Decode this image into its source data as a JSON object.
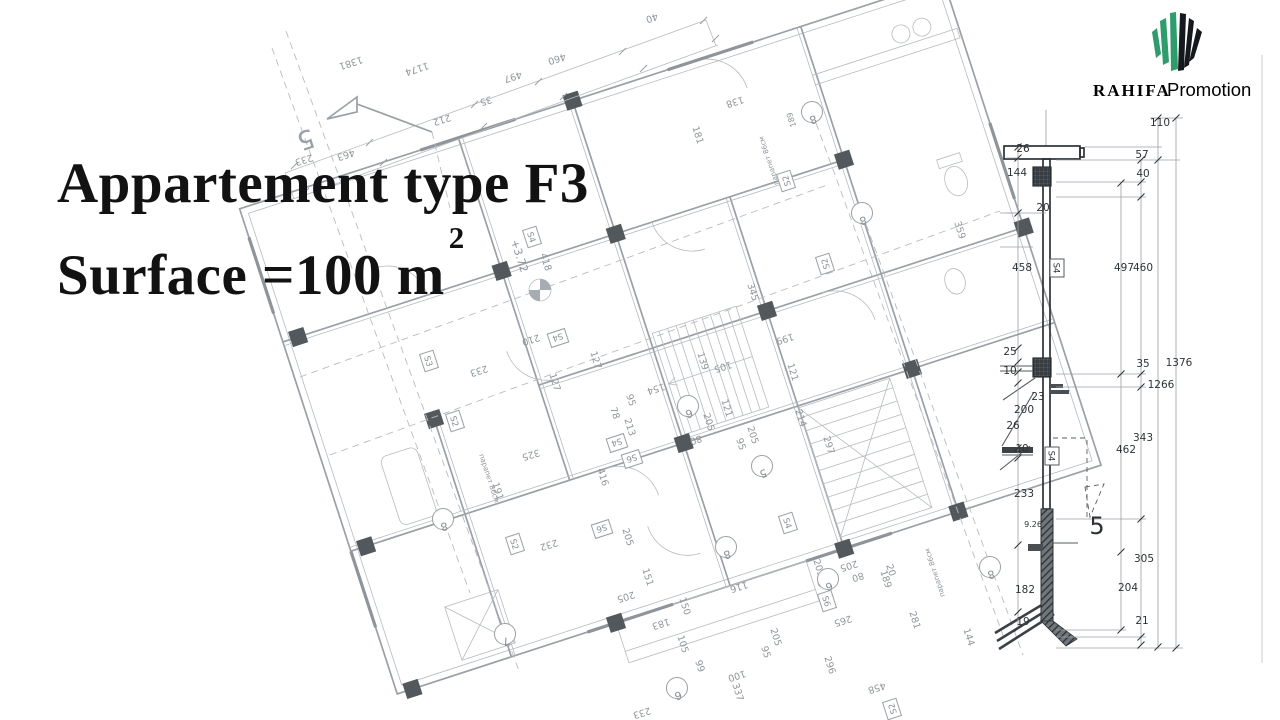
{
  "title": {
    "line1": "Appartement type F3",
    "line2": "Surface =100 m",
    "sup": "2"
  },
  "logo": {
    "brand": "RAHIFA",
    "suffix": "Promotion",
    "green": "#2f9c6e",
    "dark": "#15181c",
    "brand_color": "#1d2630",
    "suffix_color": "#4fa294"
  },
  "plan": {
    "cut_label": "5",
    "labels": [
      {
        "x": 350,
        "y": 60,
        "t": "1381",
        "r": 162
      },
      {
        "x": 416,
        "y": 66,
        "t": "1174",
        "r": 162
      },
      {
        "x": 556,
        "y": 56,
        "t": "460",
        "r": 162
      },
      {
        "x": 512,
        "y": 74,
        "t": "497",
        "r": 162
      },
      {
        "x": 485,
        "y": 98,
        "t": "35",
        "r": 162
      },
      {
        "x": 441,
        "y": 117,
        "t": "212",
        "r": 162
      },
      {
        "x": 651,
        "y": 15,
        "t": "40",
        "r": 162
      },
      {
        "x": 734,
        "y": 99,
        "t": "138",
        "r": 162
      },
      {
        "x": 695,
        "y": 136,
        "t": "181",
        "r": 72
      },
      {
        "x": 303,
        "y": 157,
        "t": "233",
        "r": 162
      },
      {
        "x": 345,
        "y": 152,
        "t": "463",
        "r": 162
      },
      {
        "x": 303,
        "y": 131,
        "t": "5",
        "r": 162,
        "f": 26,
        "c": "#9aa0a6"
      },
      {
        "x": 478,
        "y": 368,
        "t": "233",
        "r": 162
      },
      {
        "x": 530,
        "y": 337,
        "t": "210",
        "r": 162
      },
      {
        "x": 552,
        "y": 383,
        "t": "127",
        "r": 72
      },
      {
        "x": 593,
        "y": 361,
        "t": "127",
        "r": 72
      },
      {
        "x": 627,
        "y": 428,
        "t": "213",
        "r": 72
      },
      {
        "x": 612,
        "y": 414,
        "t": "78",
        "r": 72
      },
      {
        "x": 628,
        "y": 401,
        "t": "95",
        "r": 72
      },
      {
        "x": 655,
        "y": 386,
        "t": "154",
        "r": 162
      },
      {
        "x": 700,
        "y": 362,
        "t": "139",
        "r": 72
      },
      {
        "x": 722,
        "y": 364,
        "t": "105",
        "r": 162
      },
      {
        "x": 695,
        "y": 437,
        "t": "80",
        "r": 162
      },
      {
        "x": 706,
        "y": 423,
        "t": "205",
        "r": 72
      },
      {
        "x": 724,
        "y": 409,
        "t": "121",
        "r": 72
      },
      {
        "x": 738,
        "y": 445,
        "t": "95",
        "r": 72
      },
      {
        "x": 750,
        "y": 436,
        "t": "205",
        "r": 72
      },
      {
        "x": 790,
        "y": 373,
        "t": "121",
        "r": 72
      },
      {
        "x": 784,
        "y": 336,
        "t": "199",
        "r": 162
      },
      {
        "x": 798,
        "y": 419,
        "t": "214",
        "r": 72
      },
      {
        "x": 826,
        "y": 446,
        "t": "297",
        "r": 72
      },
      {
        "x": 530,
        "y": 452,
        "t": "325",
        "r": 162
      },
      {
        "x": 600,
        "y": 478,
        "t": "416",
        "r": 72
      },
      {
        "x": 495,
        "y": 492,
        "t": "191",
        "r": 72
      },
      {
        "x": 543,
        "y": 263,
        "t": "418",
        "r": 72
      },
      {
        "x": 516,
        "y": 257,
        "t": "+3.72",
        "r": 72,
        "f": 11
      },
      {
        "x": 548,
        "y": 542,
        "t": "232",
        "r": 162
      },
      {
        "x": 625,
        "y": 538,
        "t": "205",
        "r": 72
      },
      {
        "x": 645,
        "y": 578,
        "t": "151",
        "r": 72
      },
      {
        "x": 625,
        "y": 594,
        "t": "205",
        "r": 162
      },
      {
        "x": 660,
        "y": 621,
        "t": "183",
        "r": 162
      },
      {
        "x": 682,
        "y": 607,
        "t": "150",
        "r": 72
      },
      {
        "x": 738,
        "y": 584,
        "t": "116",
        "r": 162
      },
      {
        "x": 680,
        "y": 645,
        "t": "105",
        "r": 72
      },
      {
        "x": 697,
        "y": 667,
        "t": "99",
        "r": 72
      },
      {
        "x": 736,
        "y": 673,
        "t": "100",
        "r": 162
      },
      {
        "x": 735,
        "y": 693,
        "t": "337",
        "r": 72
      },
      {
        "x": 641,
        "y": 710,
        "t": "233",
        "r": 162
      },
      {
        "x": 827,
        "y": 666,
        "t": "296",
        "r": 72
      },
      {
        "x": 842,
        "y": 618,
        "t": "265",
        "r": 162
      },
      {
        "x": 773,
        "y": 638,
        "t": "205",
        "r": 72
      },
      {
        "x": 763,
        "y": 653,
        "t": "95",
        "r": 72
      },
      {
        "x": 822,
        "y": 579,
        "t": "80",
        "r": 162
      },
      {
        "x": 816,
        "y": 569,
        "t": "205",
        "r": 72
      },
      {
        "x": 848,
        "y": 563,
        "t": "205",
        "r": 162
      },
      {
        "x": 857,
        "y": 574,
        "t": "80",
        "r": 162
      },
      {
        "x": 912,
        "y": 621,
        "t": "281",
        "r": 72
      },
      {
        "x": 888,
        "y": 571,
        "t": "20",
        "r": 72
      },
      {
        "x": 966,
        "y": 638,
        "t": "144",
        "r": 72
      },
      {
        "x": 876,
        "y": 685,
        "t": "458",
        "r": 162
      },
      {
        "x": 883,
        "y": 580,
        "t": "189",
        "r": 72
      },
      {
        "x": 794,
        "y": 119,
        "t": "189",
        "r": 252,
        "f": 8
      },
      {
        "x": 750,
        "y": 293,
        "t": "345",
        "r": 72
      },
      {
        "x": 957,
        "y": 231,
        "t": "359",
        "r": 72
      },
      {
        "x": 487,
        "y": 479,
        "t": "парапет 86см",
        "r": 72,
        "f": 7
      },
      {
        "x": 937,
        "y": 572,
        "t": "парапет 86см",
        "r": 252,
        "f": 7
      },
      {
        "x": 771,
        "y": 160,
        "t": "парапет 86см",
        "r": 252,
        "f": 7
      }
    ],
    "bubbles": [
      {
        "x": 812,
        "y": 112,
        "t": "8"
      },
      {
        "x": 862,
        "y": 213,
        "t": "8"
      },
      {
        "x": 443,
        "y": 519,
        "t": "8"
      },
      {
        "x": 505,
        "y": 634,
        "t": "7"
      },
      {
        "x": 726,
        "y": 547,
        "t": "8"
      },
      {
        "x": 762,
        "y": 466,
        "t": "5"
      },
      {
        "x": 688,
        "y": 406,
        "t": "6"
      },
      {
        "x": 677,
        "y": 688,
        "t": "6"
      },
      {
        "x": 828,
        "y": 579,
        "t": "6"
      },
      {
        "x": 990,
        "y": 567,
        "t": "8"
      }
    ],
    "tags": [
      {
        "x": 558,
        "y": 338,
        "t": "S4",
        "r": 162
      },
      {
        "x": 515,
        "y": 544,
        "t": "S2",
        "r": 72
      },
      {
        "x": 786,
        "y": 181,
        "t": "S2",
        "r": 252
      },
      {
        "x": 825,
        "y": 264,
        "t": "S2",
        "r": 252
      },
      {
        "x": 602,
        "y": 529,
        "t": "S6",
        "r": 162
      },
      {
        "x": 788,
        "y": 523,
        "t": "S4",
        "r": 72
      },
      {
        "x": 429,
        "y": 361,
        "t": "S3",
        "r": 72
      },
      {
        "x": 455,
        "y": 421,
        "t": "S2",
        "r": 72
      },
      {
        "x": 632,
        "y": 459,
        "t": "S6",
        "r": 162
      },
      {
        "x": 617,
        "y": 443,
        "t": "S4",
        "r": 162
      },
      {
        "x": 532,
        "y": 237,
        "t": "S4",
        "r": 72
      },
      {
        "x": 827,
        "y": 601,
        "t": "S6",
        "r": 72
      },
      {
        "x": 892,
        "y": 709,
        "t": "S2",
        "r": 252
      }
    ]
  },
  "section": {
    "labels": [
      {
        "x": 1023,
        "y": 152,
        "t": "26"
      },
      {
        "x": 1017,
        "y": 176,
        "t": "144"
      },
      {
        "x": 1043,
        "y": 211,
        "t": "20"
      },
      {
        "x": 1022,
        "y": 271,
        "t": "458"
      },
      {
        "x": 1010,
        "y": 355,
        "t": "25"
      },
      {
        "x": 1010,
        "y": 374,
        "t": "10"
      },
      {
        "x": 1038,
        "y": 400,
        "t": "23"
      },
      {
        "x": 1024,
        "y": 413,
        "t": "200"
      },
      {
        "x": 1013,
        "y": 429,
        "t": "26"
      },
      {
        "x": 1022,
        "y": 452,
        "t": "10"
      },
      {
        "x": 1024,
        "y": 497,
        "t": "233"
      },
      {
        "x": 1033,
        "y": 527,
        "t": "9.26",
        "f": 8
      },
      {
        "x": 1025,
        "y": 593,
        "t": "182"
      },
      {
        "x": 1023,
        "y": 625,
        "t": "19"
      },
      {
        "x": 1124,
        "y": 271,
        "t": "497"
      },
      {
        "x": 1126,
        "y": 453,
        "t": "462"
      },
      {
        "x": 1128,
        "y": 591,
        "t": "204"
      },
      {
        "x": 1142,
        "y": 158,
        "t": "57"
      },
      {
        "x": 1143,
        "y": 177,
        "t": "40"
      },
      {
        "x": 1143,
        "y": 271,
        "t": "460"
      },
      {
        "x": 1143,
        "y": 367,
        "t": "35"
      },
      {
        "x": 1143,
        "y": 441,
        "t": "343"
      },
      {
        "x": 1144,
        "y": 562,
        "t": "305"
      },
      {
        "x": 1142,
        "y": 624,
        "t": "21"
      },
      {
        "x": 1160,
        "y": 126,
        "t": "110"
      },
      {
        "x": 1161,
        "y": 388,
        "t": "1266"
      },
      {
        "x": 1179,
        "y": 366,
        "t": "1376"
      },
      {
        "x": 1097,
        "y": 534,
        "t": "5",
        "f": 24,
        "c": "#2c3136"
      }
    ],
    "tags": [
      {
        "x": 1057,
        "y": 268,
        "t": "S4",
        "r": 90
      },
      {
        "x": 1052,
        "y": 456,
        "t": "S4",
        "r": 90
      }
    ]
  }
}
